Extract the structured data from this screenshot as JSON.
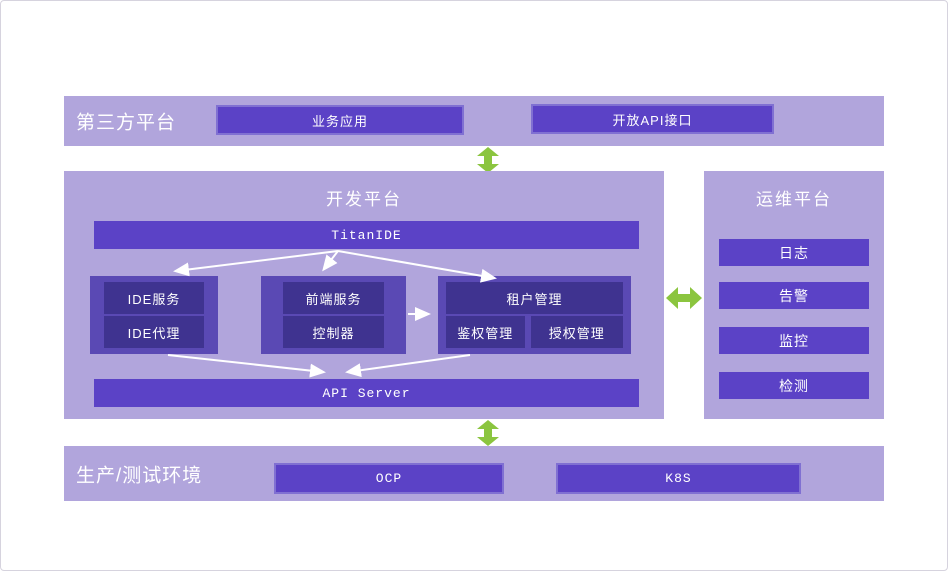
{
  "colors": {
    "panel_light": "#b1a5dc",
    "box_primary": "#5b42c6",
    "group_container": "#5a49b4",
    "group_inner": "#3f3390",
    "arrow_green": "#8bc53f",
    "connector_white": "#ffffff"
  },
  "third_party": {
    "title": "第三方平台",
    "boxes": [
      "业务应用",
      "开放API接口"
    ]
  },
  "dev_platform": {
    "title": "开发平台",
    "top_bar": "TitanIDE",
    "bottom_bar": "API Server",
    "groups": [
      {
        "items": [
          "IDE服务",
          "IDE代理"
        ]
      },
      {
        "items": [
          "前端服务",
          "控制器"
        ]
      },
      {
        "header": "租户管理",
        "items": [
          "鉴权管理",
          "授权管理"
        ]
      }
    ]
  },
  "ops_platform": {
    "title": "运维平台",
    "items": [
      "日志",
      "告警",
      "监控",
      "检测"
    ]
  },
  "environment": {
    "title": "生产/测试环境",
    "boxes": [
      "OCP",
      "K8S"
    ]
  }
}
